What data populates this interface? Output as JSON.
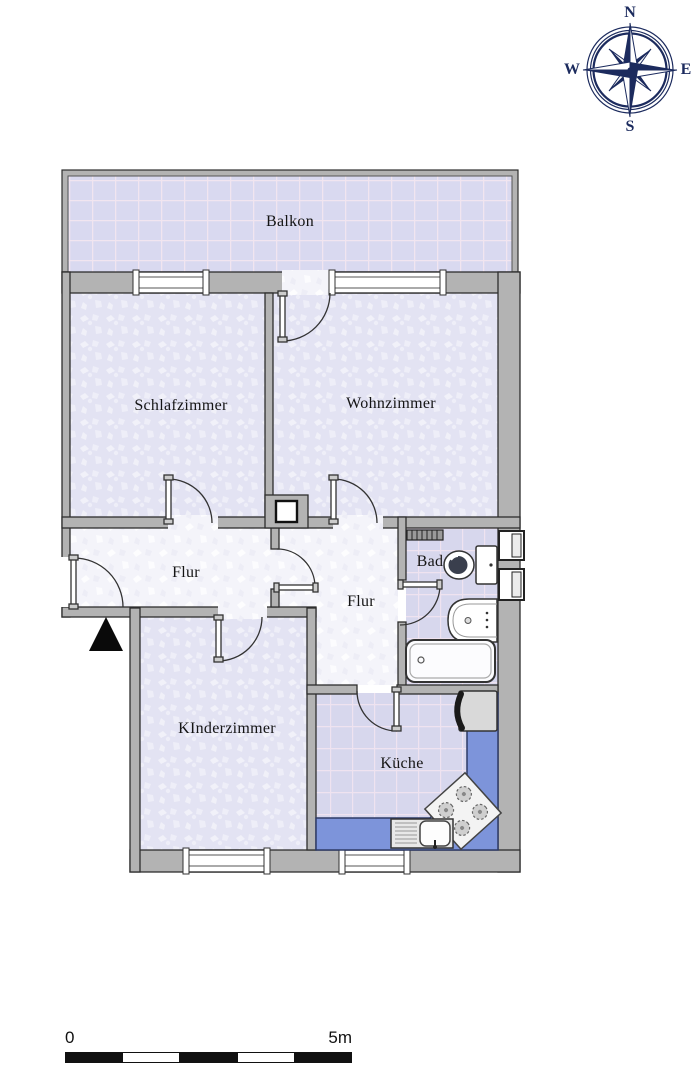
{
  "compass": {
    "north": "N",
    "east": "E",
    "south": "S",
    "west": "W"
  },
  "rooms": {
    "balkon": "Balkon",
    "schlafzimmer": "Schlafzimmer",
    "wohnzimmer": "Wohnzimmer",
    "flur_links": "Flur",
    "flur_mitte": "Flur",
    "bad": "Bad",
    "kinderzimmer": "KInderzimmer",
    "kueche": "Küche"
  },
  "scale_bar": {
    "start_label": "0",
    "end_label": "5m"
  },
  "colors": {
    "wall_fill": "#b3b3b3",
    "wall_outline": "#2e2e2e",
    "room_carpet": "#e4e4f4",
    "hall_floor": "#f5f5fa",
    "tile_floor": "#d7d7ed",
    "tile_grout": "#efe3f0",
    "kitchen_counter": "#7d94da",
    "compass_navy": "#1c2b5e"
  }
}
